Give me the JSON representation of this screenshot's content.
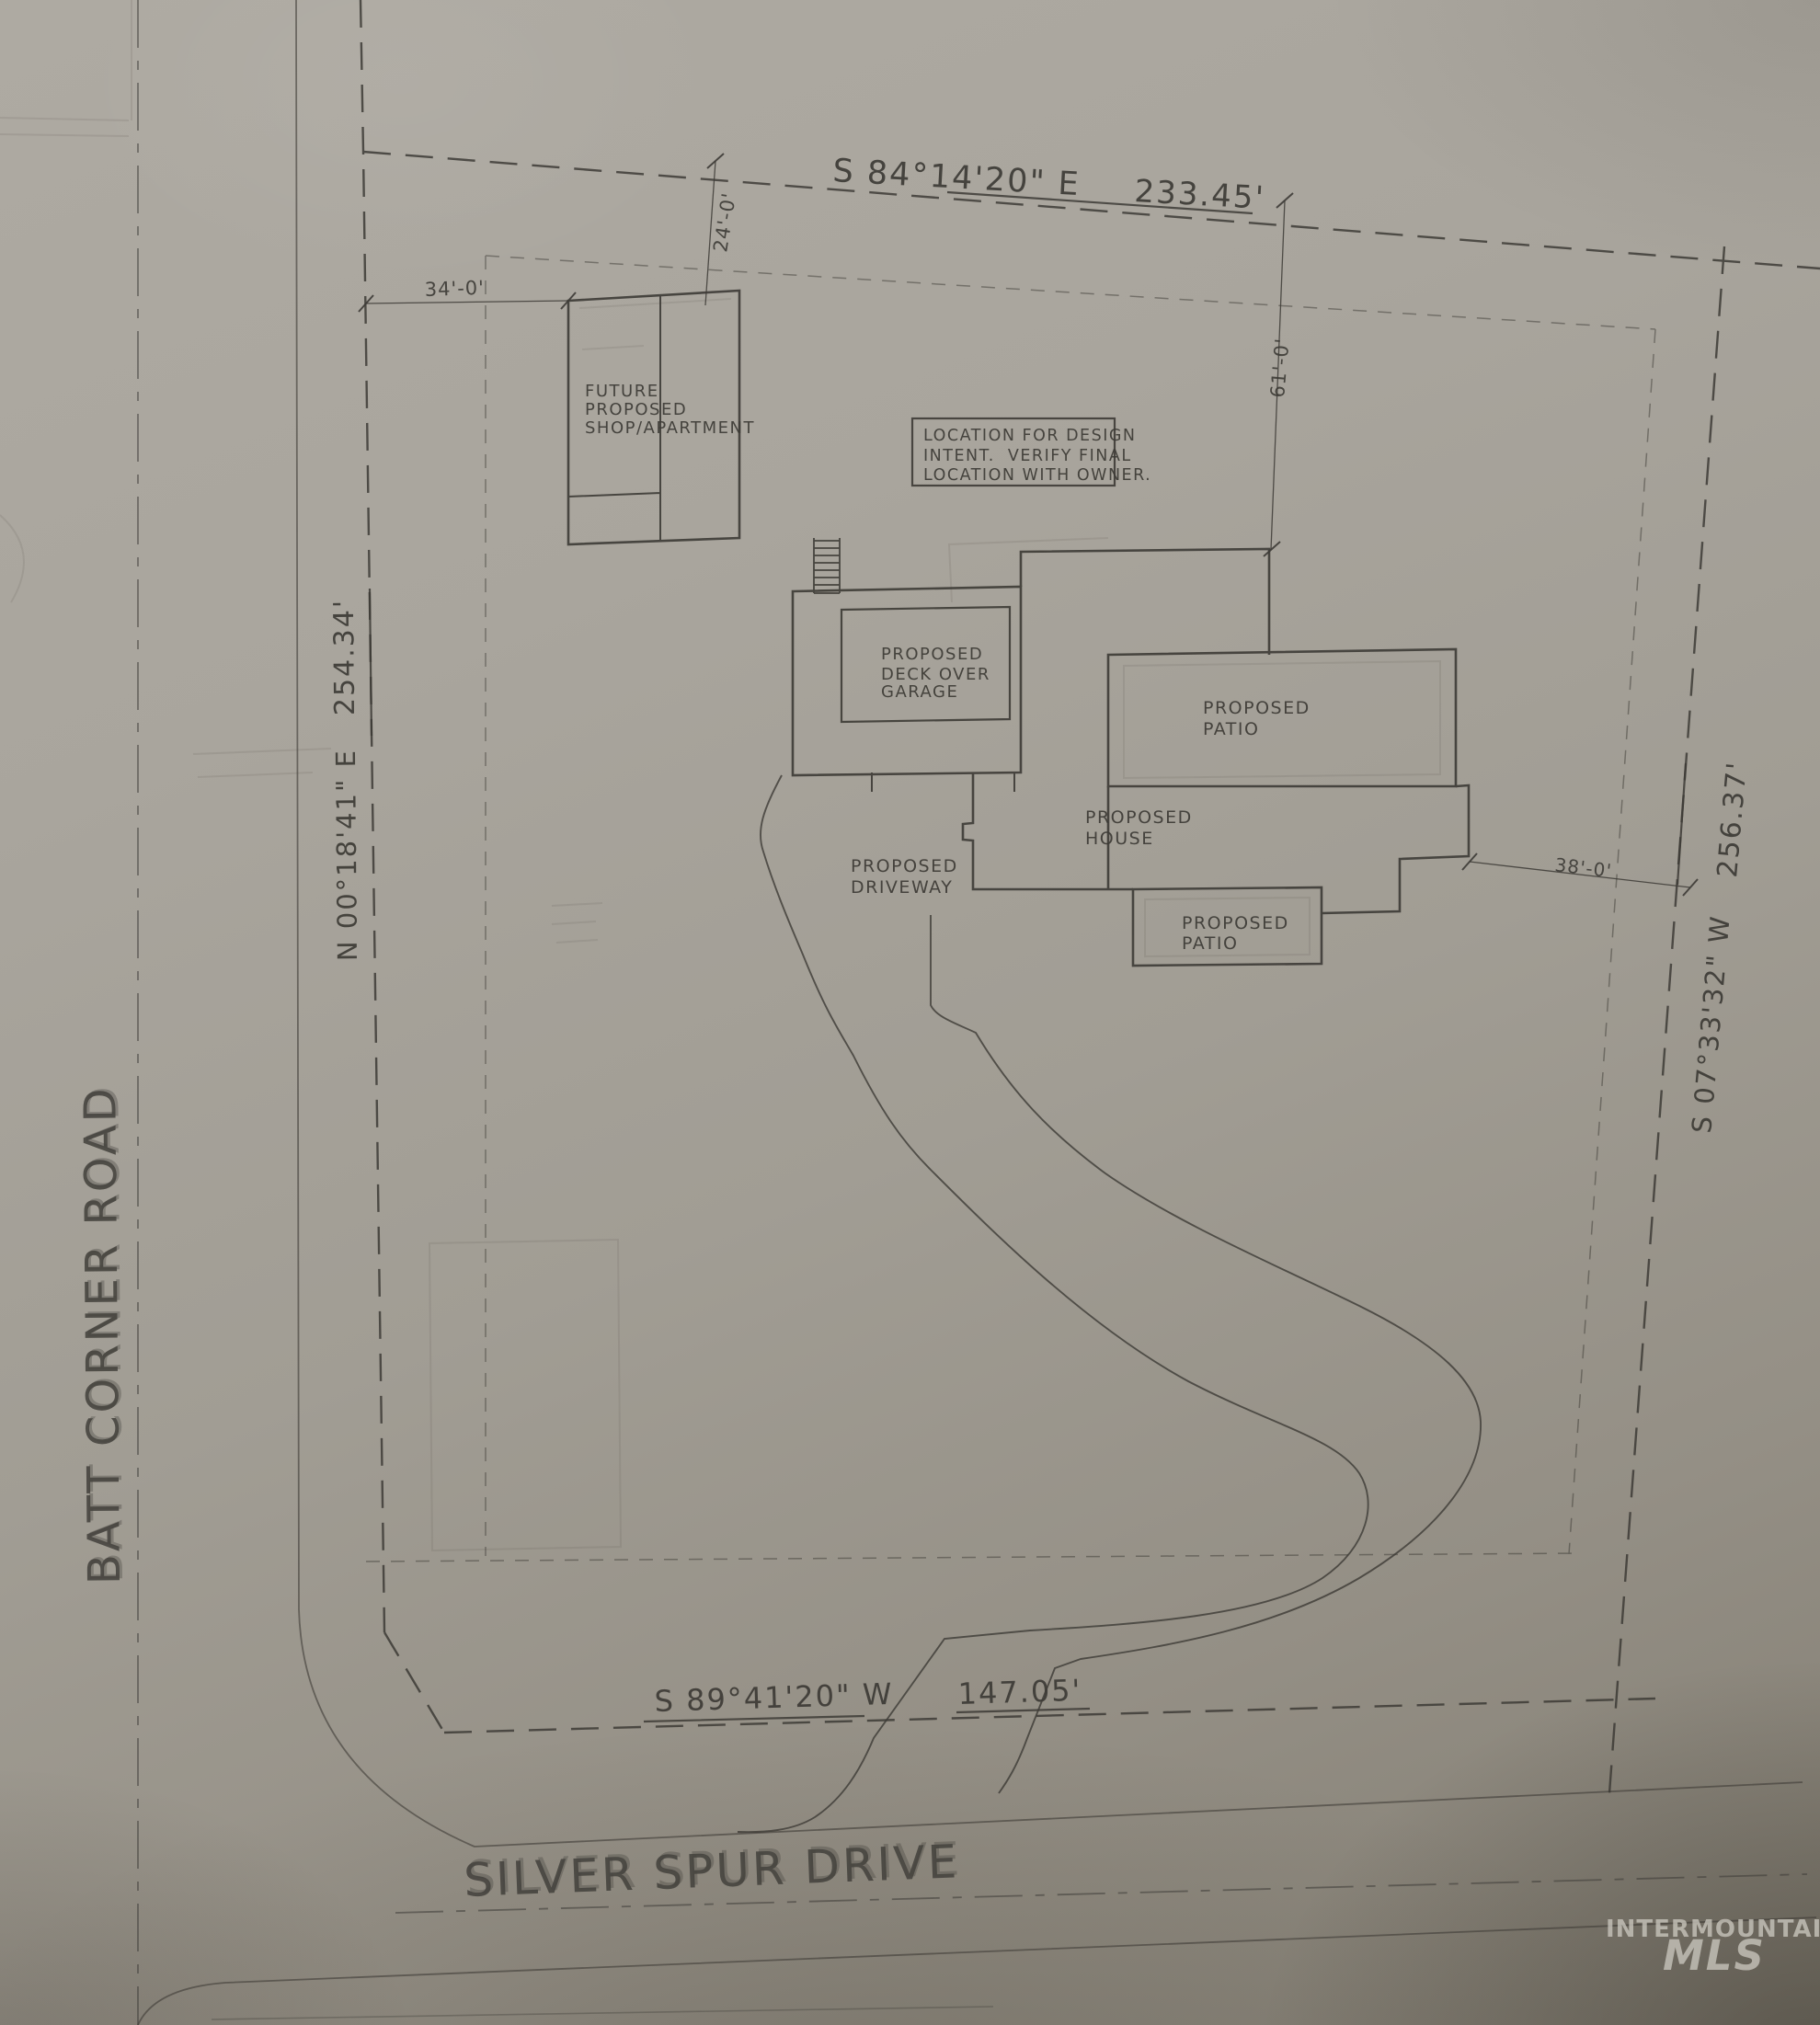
{
  "streets": {
    "west": "BATT CORNER ROAD",
    "south": "SILVER SPUR DRIVE"
  },
  "boundaries": {
    "north": {
      "bearing": "S 84°14'20\" E",
      "distance": "233.45'"
    },
    "west": {
      "bearing": "N 00°18'41\" E",
      "distance": "254.34'"
    },
    "east": {
      "bearing": "S 07°33'32\" W",
      "distance": "256.37'"
    },
    "south": {
      "bearing": "S 89°41'20\" W",
      "distance": "147.05'"
    }
  },
  "dimensions": {
    "shop_setback_west": "34'-0'",
    "shop_setback_north": "24'-0'",
    "house_setback_north": "61'-0'",
    "house_setback_east": "38'-0'"
  },
  "labels": {
    "shop_lines": [
      "FUTURE",
      "PROPOSED",
      "SHOP/APARTMENT"
    ],
    "note_lines": [
      "LOCATION FOR DESIGN",
      "INTENT.  VERIFY FINAL",
      "LOCATION WITH OWNER."
    ],
    "deck_lines": [
      "PROPOSED",
      "DECK OVER",
      "GARAGE"
    ],
    "patio_east_lines": [
      "PROPOSED",
      "PATIO"
    ],
    "house_lines": [
      "PROPOSED",
      "HOUSE"
    ],
    "driveway_lines": [
      "PROPOSED",
      "DRIVEWAY"
    ],
    "patio_south_lines": [
      "PROPOSED",
      "PATIO"
    ]
  },
  "watermark": {
    "line1": "INTERMOUNTAIN",
    "line2": "MLS"
  },
  "colors": {
    "ink": "#3d3b36",
    "paper": "#a7a39b",
    "watermark": "#c7c4bb"
  }
}
